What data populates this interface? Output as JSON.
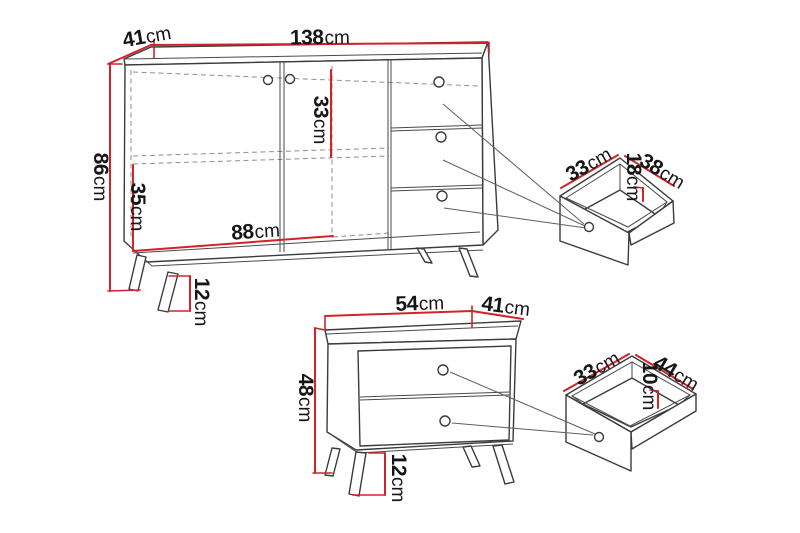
{
  "colors": {
    "dimension_red": "#d2232a",
    "outline": "#3b3b3b",
    "hidden_line": "#8f8f8f",
    "label_text": "#161616",
    "background": "#ffffff"
  },
  "sideboard": {
    "width": {
      "value": "138",
      "unit": "cm"
    },
    "depth": {
      "value": "41",
      "unit": "cm"
    },
    "height": {
      "value": "86",
      "unit": "cm"
    },
    "upper_section_height": {
      "value": "33",
      "unit": "cm"
    },
    "lower_section_height": {
      "value": "35",
      "unit": "cm"
    },
    "interior_width": {
      "value": "88",
      "unit": "cm"
    },
    "leg_height": {
      "value": "12",
      "unit": "cm"
    }
  },
  "sideboard_drawer": {
    "front_width": {
      "value": "33",
      "unit": "cm"
    },
    "depth": {
      "value": "38",
      "unit": "cm"
    },
    "inner_height": {
      "value": "18",
      "unit": "cm"
    }
  },
  "chest": {
    "width": {
      "value": "54",
      "unit": "cm"
    },
    "depth": {
      "value": "41",
      "unit": "cm"
    },
    "height": {
      "value": "48",
      "unit": "cm"
    },
    "leg_height": {
      "value": "12",
      "unit": "cm"
    }
  },
  "chest_drawer": {
    "front_width": {
      "value": "33",
      "unit": "cm"
    },
    "depth": {
      "value": "44",
      "unit": "cm"
    },
    "inner_height": {
      "value": "10",
      "unit": "cm"
    }
  }
}
